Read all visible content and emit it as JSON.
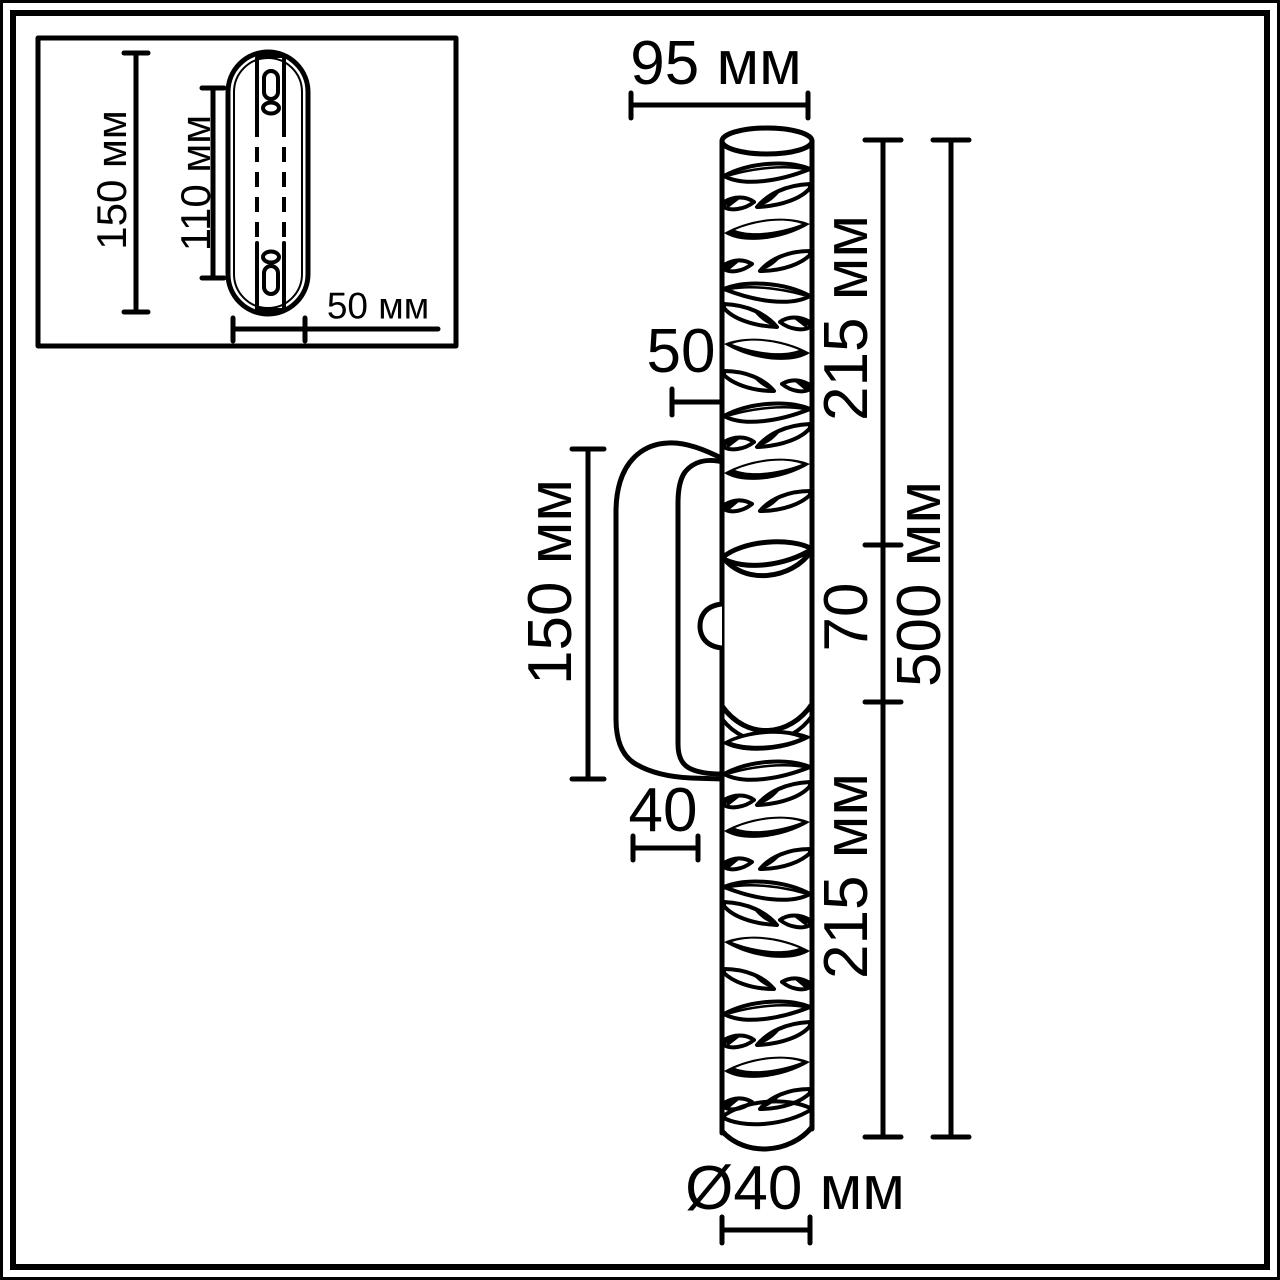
{
  "drawing": {
    "type": "technical-dimension-drawing",
    "subject": "wall-sconce-lamp",
    "unit": "мм",
    "line_color": "#000000",
    "background_color": "#ffffff"
  },
  "inset_view": {
    "name": "mounting-plate-rear-view",
    "plate_height": "150 мм",
    "hole_spacing": "110 мм",
    "plate_width": "50 мм"
  },
  "side_view": {
    "name": "lamp-side-view",
    "top_width": "95 мм",
    "tube_wall_gap": "50",
    "bracket_height": "150 мм",
    "bracket_depth": "40",
    "upper_tube_length": "215 мм",
    "center_section_length": "70",
    "lower_tube_length": "215 мм",
    "total_length": "500 мм",
    "tube_diameter": "Ø40 мм"
  }
}
